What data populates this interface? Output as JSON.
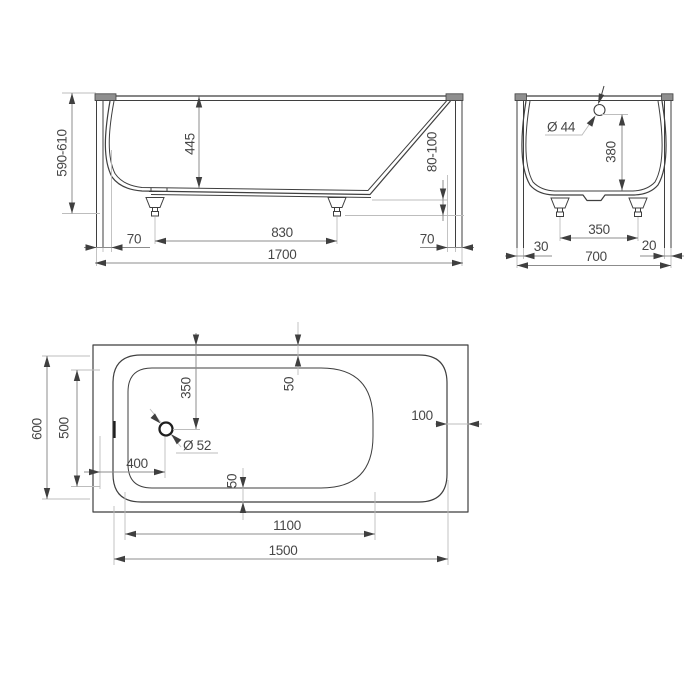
{
  "front_view": {
    "overall_height": "590-610",
    "inner_depth": "445",
    "foot_height": "80-100",
    "rim_offset_left": "70",
    "feet_distance": "830",
    "rim_offset_right": "70",
    "overall_length": "1700"
  },
  "side_view": {
    "overflow_diameter": "Ø 44",
    "overflow_depth": "380",
    "offset_left": "30",
    "feet_distance": "350",
    "offset_right": "20",
    "overall_width": "700"
  },
  "plan_view": {
    "drain_offset_top": "350",
    "rim_width_top": "50",
    "rim_width_end": "100",
    "bowl_width": "500",
    "opening_width": "600",
    "drain_offset_left": "400",
    "drain_diameter": "Ø 52",
    "rim_width_bottom": "50",
    "bowl_length": "1100",
    "opening_length": "1500"
  }
}
